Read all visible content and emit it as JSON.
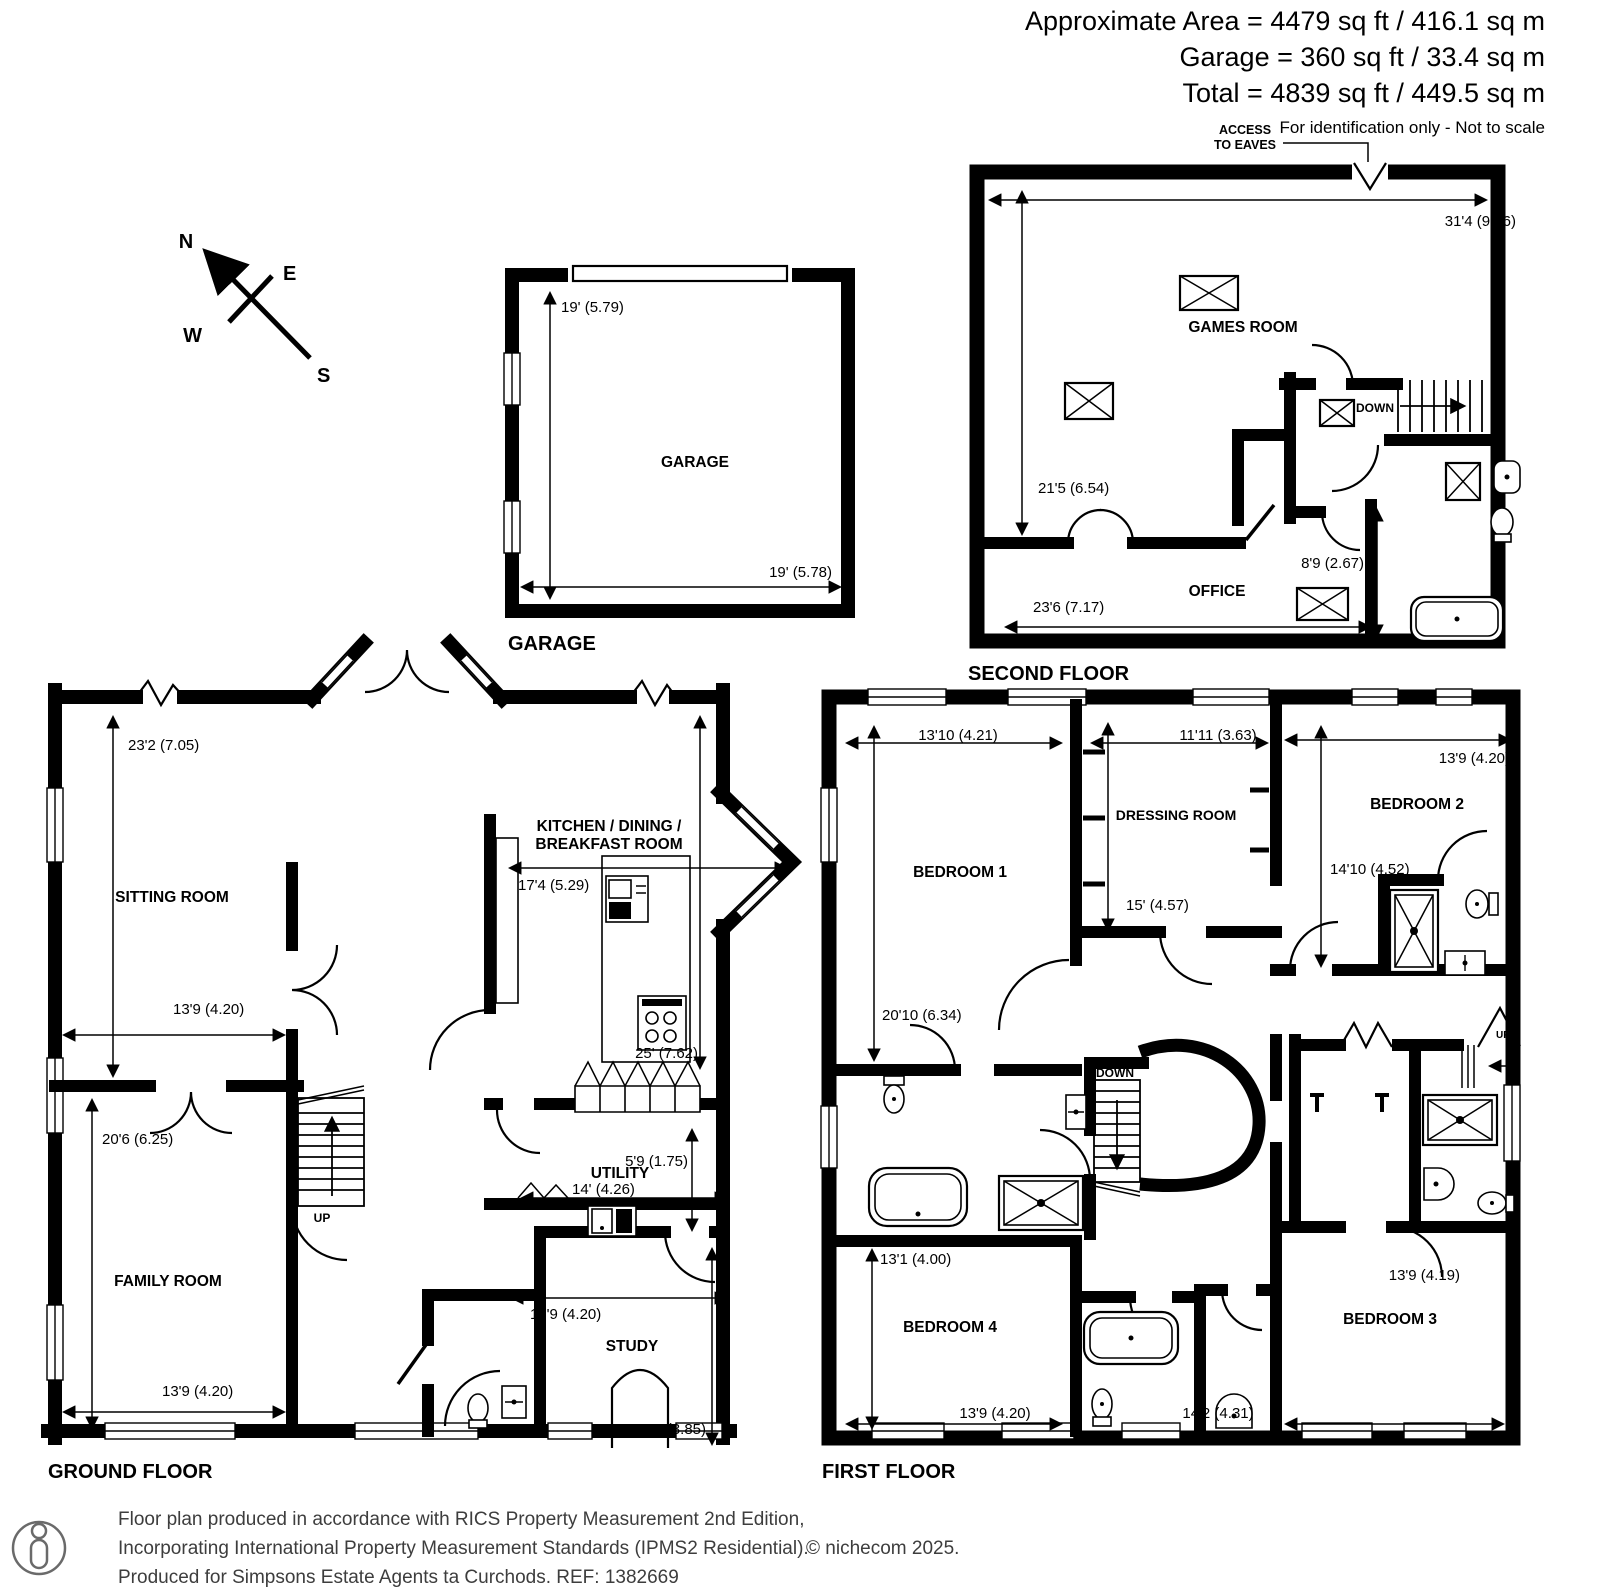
{
  "header": {
    "area_line": "Approximate Area = 4479 sq ft / 416.1 sq m",
    "garage_line": "Garage = 360 sq ft / 33.4 sq m",
    "total_line": "Total = 4839 sq ft / 449.5 sq m",
    "disclaimer": "For identification only - Not to scale",
    "access_line1": "ACCESS",
    "access_line2": "TO EAVES"
  },
  "compass": {
    "north": "N",
    "east": "E",
    "west": "W",
    "south": "S"
  },
  "garage": {
    "floor_title": "GARAGE",
    "room_label": "GARAGE",
    "dim_depth": "19' (5.79)",
    "dim_width": "19' (5.78)"
  },
  "second_floor": {
    "floor_title": "SECOND FLOOR",
    "games_room": "GAMES ROOM",
    "office": "OFFICE",
    "stairs_down": "DOWN",
    "dim_overall_width": "31'4 (9.56)",
    "dim_games_depth": "21'5 (6.54)",
    "dim_office_width": "23'6 (7.17)",
    "dim_office_depth": "8'9 (2.67)"
  },
  "ground_floor": {
    "floor_title": "GROUND FLOOR",
    "sitting_room": "SITTING ROOM",
    "family_room": "FAMILY ROOM",
    "kitchen_line1": "KITCHEN / DINING /",
    "kitchen_line2": "BREAKFAST ROOM",
    "utility": "UTILITY",
    "study": "STUDY",
    "stairs_up": "UP",
    "dim_sitting_depth": "23'2 (7.05)",
    "dim_sitting_width": "13'9 (4.20)",
    "dim_family_depth": "20'6 (6.25)",
    "dim_family_width": "13'9 (4.20)",
    "dim_kitchen_width": "17'4 (5.29)",
    "dim_kitchen_depth": "25' (7.62)",
    "dim_utility_depth": "5'9 (1.75)",
    "dim_utility_width": "14' (4.26)",
    "dim_study_width": "13'9 (4.20)",
    "dim_study_depth": "12'8 (3.85)"
  },
  "first_floor": {
    "floor_title": "FIRST FLOOR",
    "bedroom1": "BEDROOM 1",
    "bedroom2": "BEDROOM 2",
    "bedroom3": "BEDROOM 3",
    "bedroom4": "BEDROOM 4",
    "dressing_room": "DRESSING ROOM",
    "stairs_down": "DOWN",
    "stairs_up": "UP",
    "dim_bedroom1_width": "13'10 (4.21)",
    "dim_dressing_width": "11'11 (3.63)",
    "dim_bedroom2_width": "13'9 (4.20)",
    "dim_bedroom1_depth": "20'10 (6.34)",
    "dim_dressing_depth": "15' (4.57)",
    "dim_bedroom2_depth": "14'10 (4.52)",
    "dim_bedroom4_depth": "13'1 (4.00)",
    "dim_bedroom4_width": "13'9 (4.20)",
    "dim_bedroom3_depth": "13'9 (4.19)",
    "dim_bedroom3_width": "14'2 (4.31)"
  },
  "footer": {
    "line1": "Floor plan produced in accordance with RICS Property Measurement 2nd Edition,",
    "line2": "Incorporating International Property Measurement Standards (IPMS2 Residential).",
    "copyright": "© nichecom 2025.",
    "line3": "Produced for Simpsons Estate Agents ta Curchods.   REF: 1382669"
  }
}
